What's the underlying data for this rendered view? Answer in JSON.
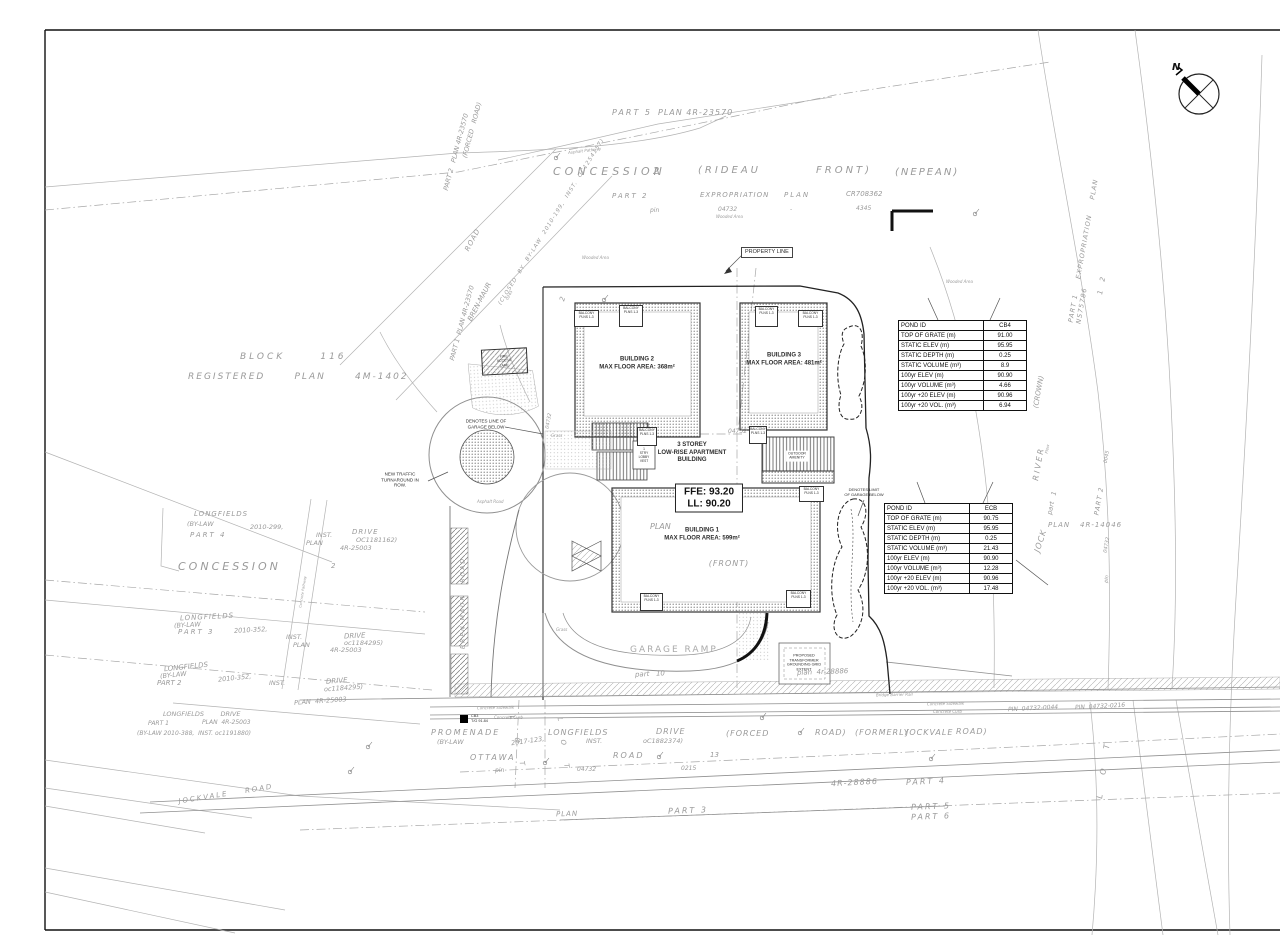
{
  "north": {
    "label": "N"
  },
  "c": {
    "plan": "PLAN",
    "inst": "INST.",
    "drive": "DRIVE",
    "longfields": "LONGFIELDS",
    "bylaw": "(BY-LAW",
    "r25003": "4R-25003",
    "r28886": "4R-28886",
    "part1": "PART 1",
    "part2": "PART 2",
    "part3": "PART 3",
    "part4": "PART 4",
    "part5": "PART 5",
    "part6": "PART 6",
    "road": "ROAD",
    "road_p": "ROAD)",
    "n04732": "04732",
    "pin": "pin",
    "concession": "CONCESSION",
    "wooded": "Wooded Area",
    "grass": "Grass",
    "sidewalk": "Concrete Sidewalk",
    "curb": "Concrete Curb"
  },
  "labels": {
    "plan4r23570": "PLAN 4R-23570",
    "two": "2",
    "rideau": "(RIDEAU",
    "front_p": "FRONT)",
    "nepean": "(NEPEAN)",
    "expropriation": "EXPROPRIATION",
    "cr708362": "CR708362",
    "dash": "-",
    "n4345": "4345",
    "part2plan_rot": "PART 2   PLAN 4R-23570",
    "forced_road": "(FORCED   ROAD)",
    "brenmaur": "BREN-MAUR",
    "brenmaur_road": "BREN-MAUR   ROAD",
    "closedby": "(CLOSED  BY  BY-LAW  2010-199,  INST.  OC1254157)",
    "part1plan_rot": "PART 1  PLAN 4R-23570",
    "n0245": "0245",
    "block116": "BLOCK      116",
    "regplan": "REGISTERED      PLAN      4M-1402",
    "n2010_299": "2010-299,",
    "oc1181162": "OC1181162)",
    "n2010_352": "2010-352,",
    "oc1184295": "oc1184295)",
    "plan_r25003": "PLAN  4R-25003",
    "longfields_drive": "LONGFIELDS        DRIVE",
    "n2010_388": "(BY-LAW 2010-388,  INST. oc1191880)",
    "promenade": "PROMENADE",
    "n2017_123": "2017-123,",
    "oc1882374": "oC1882374)",
    "ottawa": "OTTAWA",
    "n13": "13",
    "n0215": "0215",
    "forced": "(FORCED",
    "formerly": "(FORMERLY",
    "jockvale": "JOCKVALE",
    "jockvale_road": "JOCKVALE    ROAD",
    "pin0044": "PIN  04732-0044",
    "pin0216": "PIN  04732-0216",
    "part10": "part   10",
    "plan4r28886": "plan  4r-28886",
    "exprop_rot": "PART 1     EXPROPRIATION     PLAN     NS75786",
    "n12": "1    2",
    "crown": "(CROWN)",
    "river": "RIVER",
    "flow": "Flow",
    "jock": "JOCK",
    "part1_lc": "part   1",
    "r14046": "4R-14046",
    "n0045": "0045",
    "front_full": "(FRONT)",
    "asphalt_pathway": "Asphalt Pathway",
    "asphalt_road": "Asphalt Road",
    "bridge_rail": "Bridge Barrier Rail",
    "concrete_pathway": "Concrete Pathway",
    "lot": "L   O   T"
  },
  "buildings": {
    "b1": "BUILDING 1\nMAX FLOOR AREA: 599m²",
    "b2": "BUILDING 2\nMAX FLOOR AREA: 368m²",
    "b3": "BUILDING 3\nMAX FLOOR AREA: 481m²"
  },
  "ann": {
    "storey": "3 STOREY\nLOW-RISE APARTMENT\nBUILDING",
    "ffe": "FFE: 93.20",
    "ll": "LL: 90.20",
    "property_line": "PROPERTY LINE",
    "balcony": "BALCONY\nPLNS 1-3",
    "denotes_line": "DENOTES LINE OF\nGARAGE BELOW",
    "denotes_limit": "DENOTES LIMIT\nOF GARAGE BELOW",
    "new_traffic": "NEW TRAFFIC\nTURNAROUND IN\nROW.",
    "garage_ramp": "GARAGE RAMP",
    "outdoor": "OUTDOOR\nAMENITY",
    "transformer": "PROPOSED\nTRANSFORMER\nGROUNDING GRID\nEXTENT",
    "fire": "FIRE\nACCESS\nLANE",
    "lobby": "1\nSTRY\nLOBBY\nVEST",
    "cb3": "CB3\nT/G 91.84"
  },
  "tables": {
    "cb4": {
      "rows": [
        {
          "label": "POND ID",
          "value": "CB4"
        },
        {
          "label": "TOP OF GRATE (m)",
          "value": "91.00"
        },
        {
          "label": "STATIC ELEV (m)",
          "value": "95.95"
        },
        {
          "label": "STATIC DEPTH (m)",
          "value": "0.25"
        },
        {
          "label": "STATIC VOLUME (m³)",
          "value": "8.9"
        },
        {
          "label": "100yr ELEV (m)",
          "value": "90.90"
        },
        {
          "label": "100yr VOLUME (m³)",
          "value": "4.66"
        },
        {
          "label": "100yr +20 ELEV (m)",
          "value": "90.96"
        },
        {
          "label": "100yr +20 VOL. (m³)",
          "value": "6.94"
        }
      ]
    },
    "ecb": {
      "rows": [
        {
          "label": "POND ID",
          "value": "ECB"
        },
        {
          "label": "TOP OF GRATE (m)",
          "value": "90.75"
        },
        {
          "label": "STATIC ELEV (m)",
          "value": "95.95"
        },
        {
          "label": "STATIC DEPTH (m)",
          "value": "0.25"
        },
        {
          "label": "STATIC VOLUME (m³)",
          "value": "21.43"
        },
        {
          "label": "100yr ELEV (m)",
          "value": "90.90"
        },
        {
          "label": "100yr VOLUME (m³)",
          "value": "12.28"
        },
        {
          "label": "100yr +20 ELEV (m)",
          "value": "90.96"
        },
        {
          "label": "100yr +20 VOL. (m³)",
          "value": "17.48"
        }
      ]
    }
  }
}
